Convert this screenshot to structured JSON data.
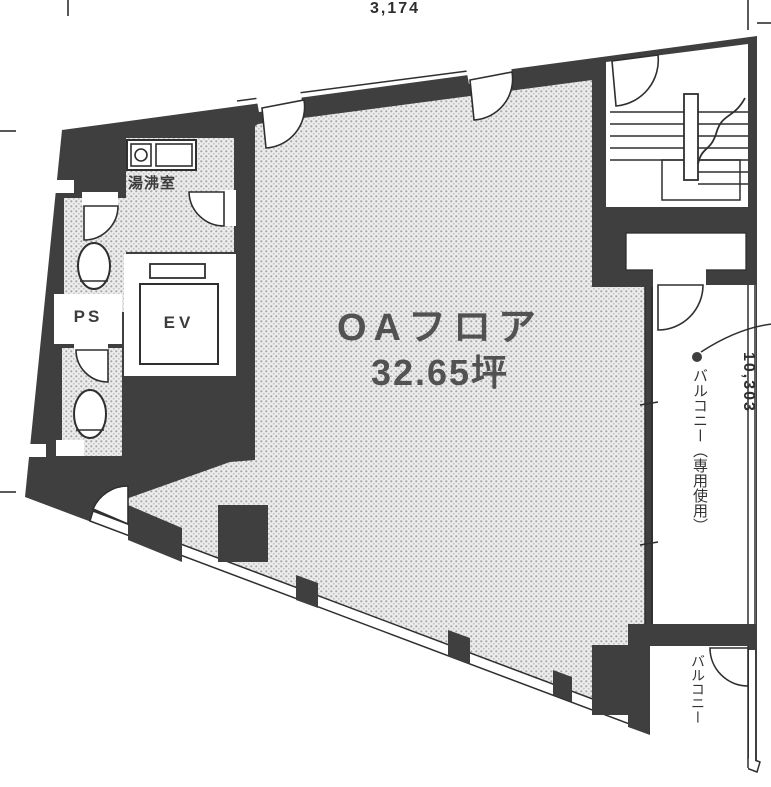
{
  "floor_plan": {
    "area": {
      "line1": "OAフロア",
      "line2": "32.65坪"
    },
    "rooms": {
      "elevator": "EV",
      "pipe_shaft": "PS",
      "kitchenette": "湯沸室",
      "balcony_private": "バルコニー（専用使用）",
      "balcony": "バルコニー"
    },
    "dimensions": {
      "top_width": "3,174",
      "right_height": "10,303"
    },
    "colors": {
      "wall": "#3f3f3f",
      "floor_dot_base": "#ededed",
      "floor_dot": "#a6a6a6",
      "line": "#2f2f2f",
      "text": "#4e4e4e"
    }
  }
}
